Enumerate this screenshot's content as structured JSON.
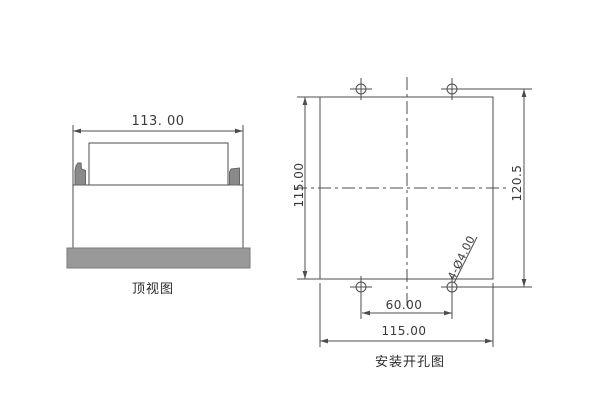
{
  "drawing": {
    "top_view": {
      "caption": "顶视图",
      "width_dim": "113. 00"
    },
    "mounting_view": {
      "caption": "安装开孔图",
      "cutout_height_dim": "115.00",
      "overall_height_dim": "120.5",
      "hole_spacing_dim": "60.00",
      "cutout_width_dim": "115.00",
      "hole_callout": "4-Ø4.00"
    },
    "colors": {
      "line": "#4d4d4d",
      "bezel_gray": "#999999",
      "clip_gray": "#8a8a8a",
      "background": "#ffffff"
    }
  }
}
